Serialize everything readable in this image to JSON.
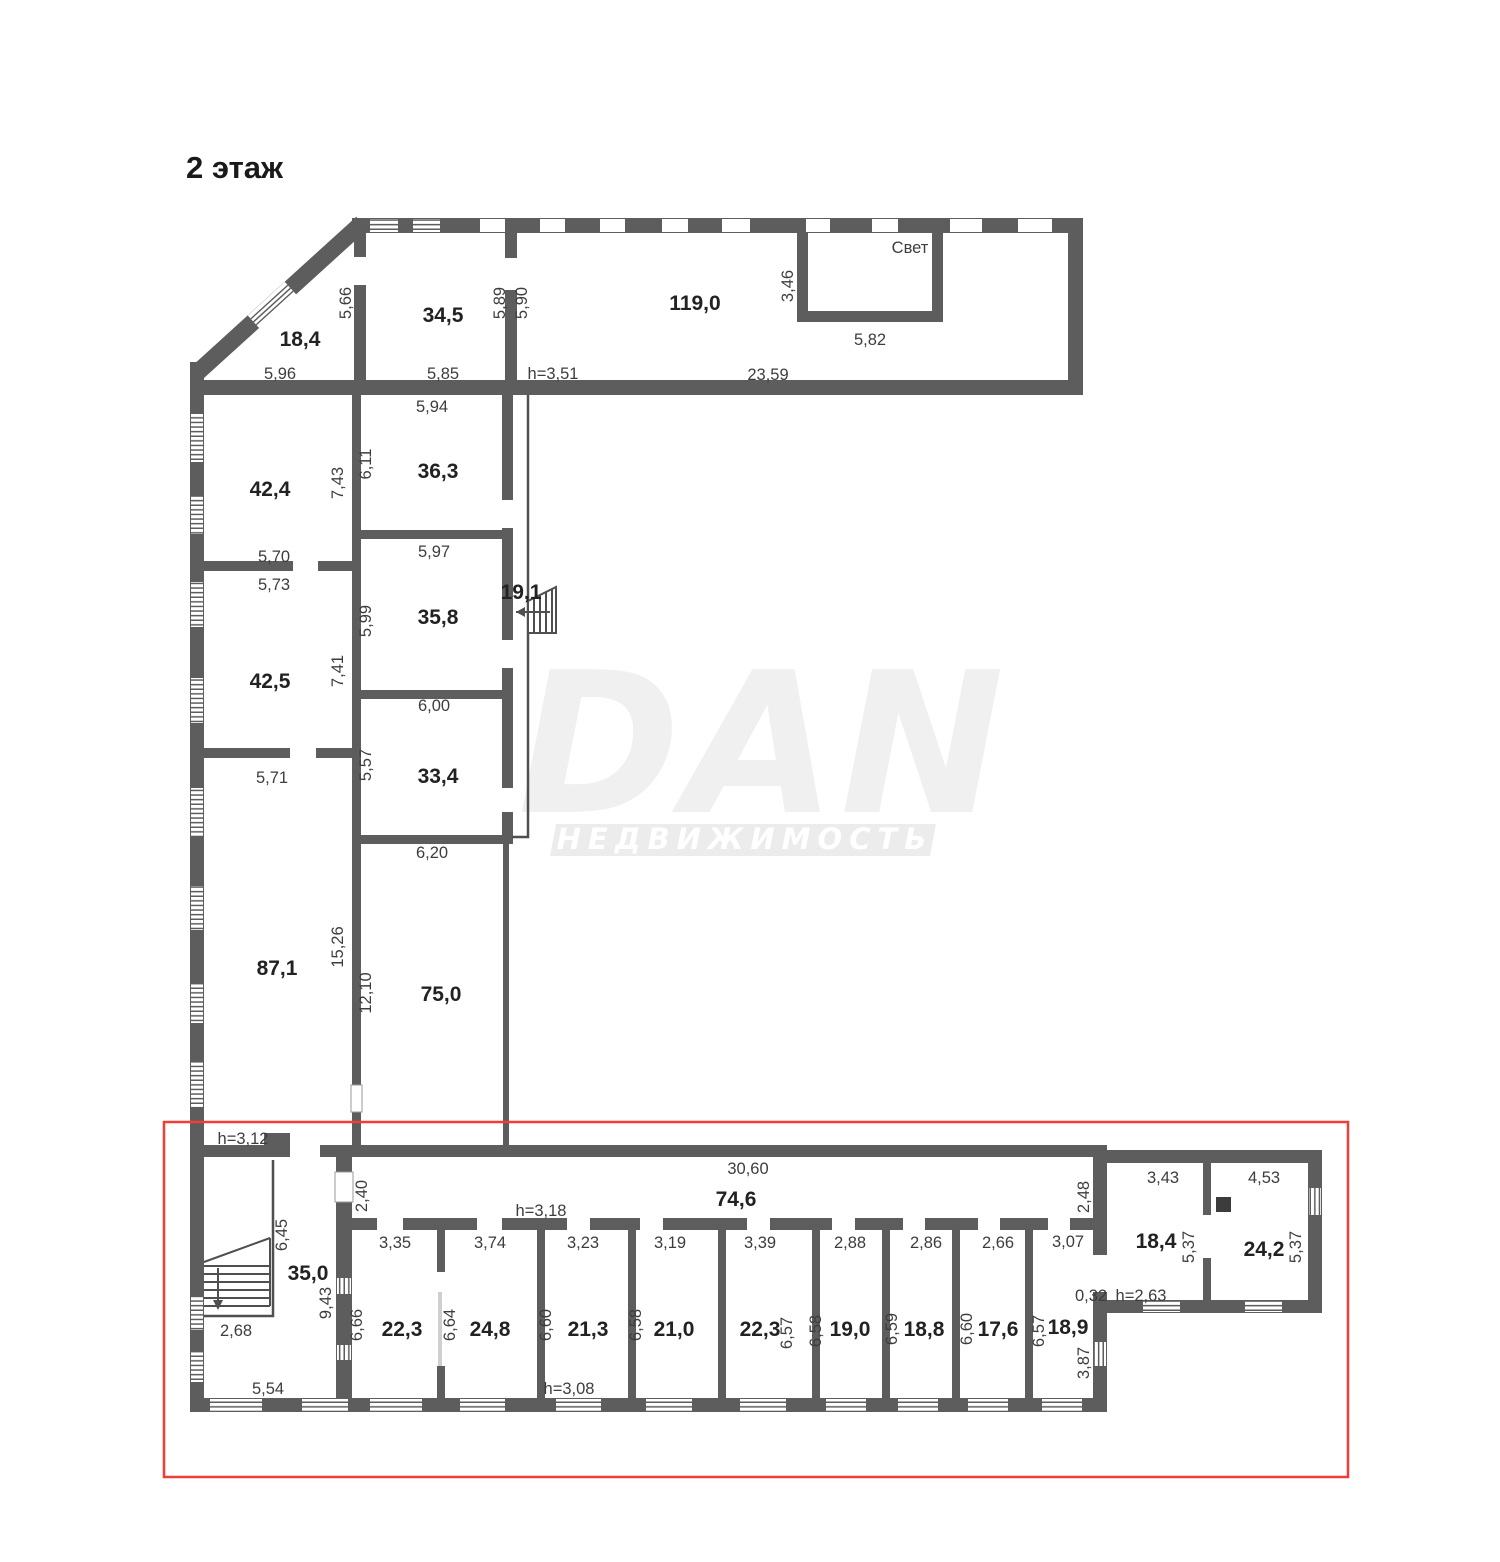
{
  "title": "2 этаж",
  "legend": {
    "svet": "Свет"
  },
  "watermark": {
    "logo": "DAN",
    "subtitle": "НЕДВИЖИМОСТЬ"
  },
  "colors": {
    "wall": "#5d5d5d",
    "thin_line": "#4f4f4f",
    "highlight": "#ef3e38",
    "watermark": "#ececec"
  },
  "areas": {
    "r18_4": "18,4",
    "r34_5": "34,5",
    "r119_0": "119,0",
    "r42_4": "42,4",
    "r36_3": "36,3",
    "r42_5": "42,5",
    "r35_8": "35,8",
    "r19_1": "19,1",
    "r33_4": "33,4",
    "r87_1": "87,1",
    "r75_0": "75,0",
    "r35_0": "35,0",
    "r74_6": "74,6",
    "r22_3a": "22,3",
    "r24_8": "24,8",
    "r21_3": "21,3",
    "r21_0": "21,0",
    "r22_3b": "22,3",
    "r19_0": "19,0",
    "r18_8": "18,8",
    "r17_6": "17,6",
    "r18_9": "18,9",
    "r18_4b": "18,4",
    "r24_2": "24,2"
  },
  "dims": {
    "d5_96": "5,96",
    "d5_66": "5,66",
    "d5_85": "5,85",
    "d5_89": "5,89",
    "d5_90": "5,90",
    "h3_51": "h=3,51",
    "d23_59": "23,59",
    "d3_46": "3,46",
    "d5_82": "5,82",
    "d5_94": "5,94",
    "d6_11": "6,11",
    "d7_43": "7,43",
    "d5_70": "5,70",
    "d5_73": "5,73",
    "d5_97": "5,97",
    "d5_99": "5,99",
    "d7_41": "7,41",
    "d6_00": "6,00",
    "d5_71": "5,71",
    "d5_57": "5,57",
    "d6_20": "6,20",
    "d15_26": "15,26",
    "d12_10": "12,10",
    "h3_12": "h=3,12",
    "d2_40": "2,40",
    "d30_60": "30,60",
    "h3_18": "h=3,18",
    "d2_48": "2,48",
    "d6_45": "6,45",
    "d9_43": "9,43",
    "d2_68": "2,68",
    "d5_54": "5,54",
    "d3_35": "3,35",
    "d6_66": "6,66",
    "d3_74": "3,74",
    "d6_64": "6,64",
    "d3_23": "3,23",
    "d6_60a": "6,60",
    "d3_19": "3,19",
    "d6_58a": "6,58",
    "d3_39": "3,39",
    "d6_57a": "6,57",
    "d2_88": "2,88",
    "d6_58b": "6,58",
    "d2_86": "2,86",
    "d6_59": "6,59",
    "d2_66": "2,66",
    "d6_60b": "6,60",
    "d3_07": "3,07",
    "d6_57b": "6,57",
    "h3_08": "h=3,08",
    "d3_87": "3,87",
    "d0_32": "0,32",
    "h2_63": "h=2,63",
    "d3_43": "3,43",
    "d5_37a": "5,37",
    "d4_53": "4,53",
    "d5_37b": "5,37"
  }
}
